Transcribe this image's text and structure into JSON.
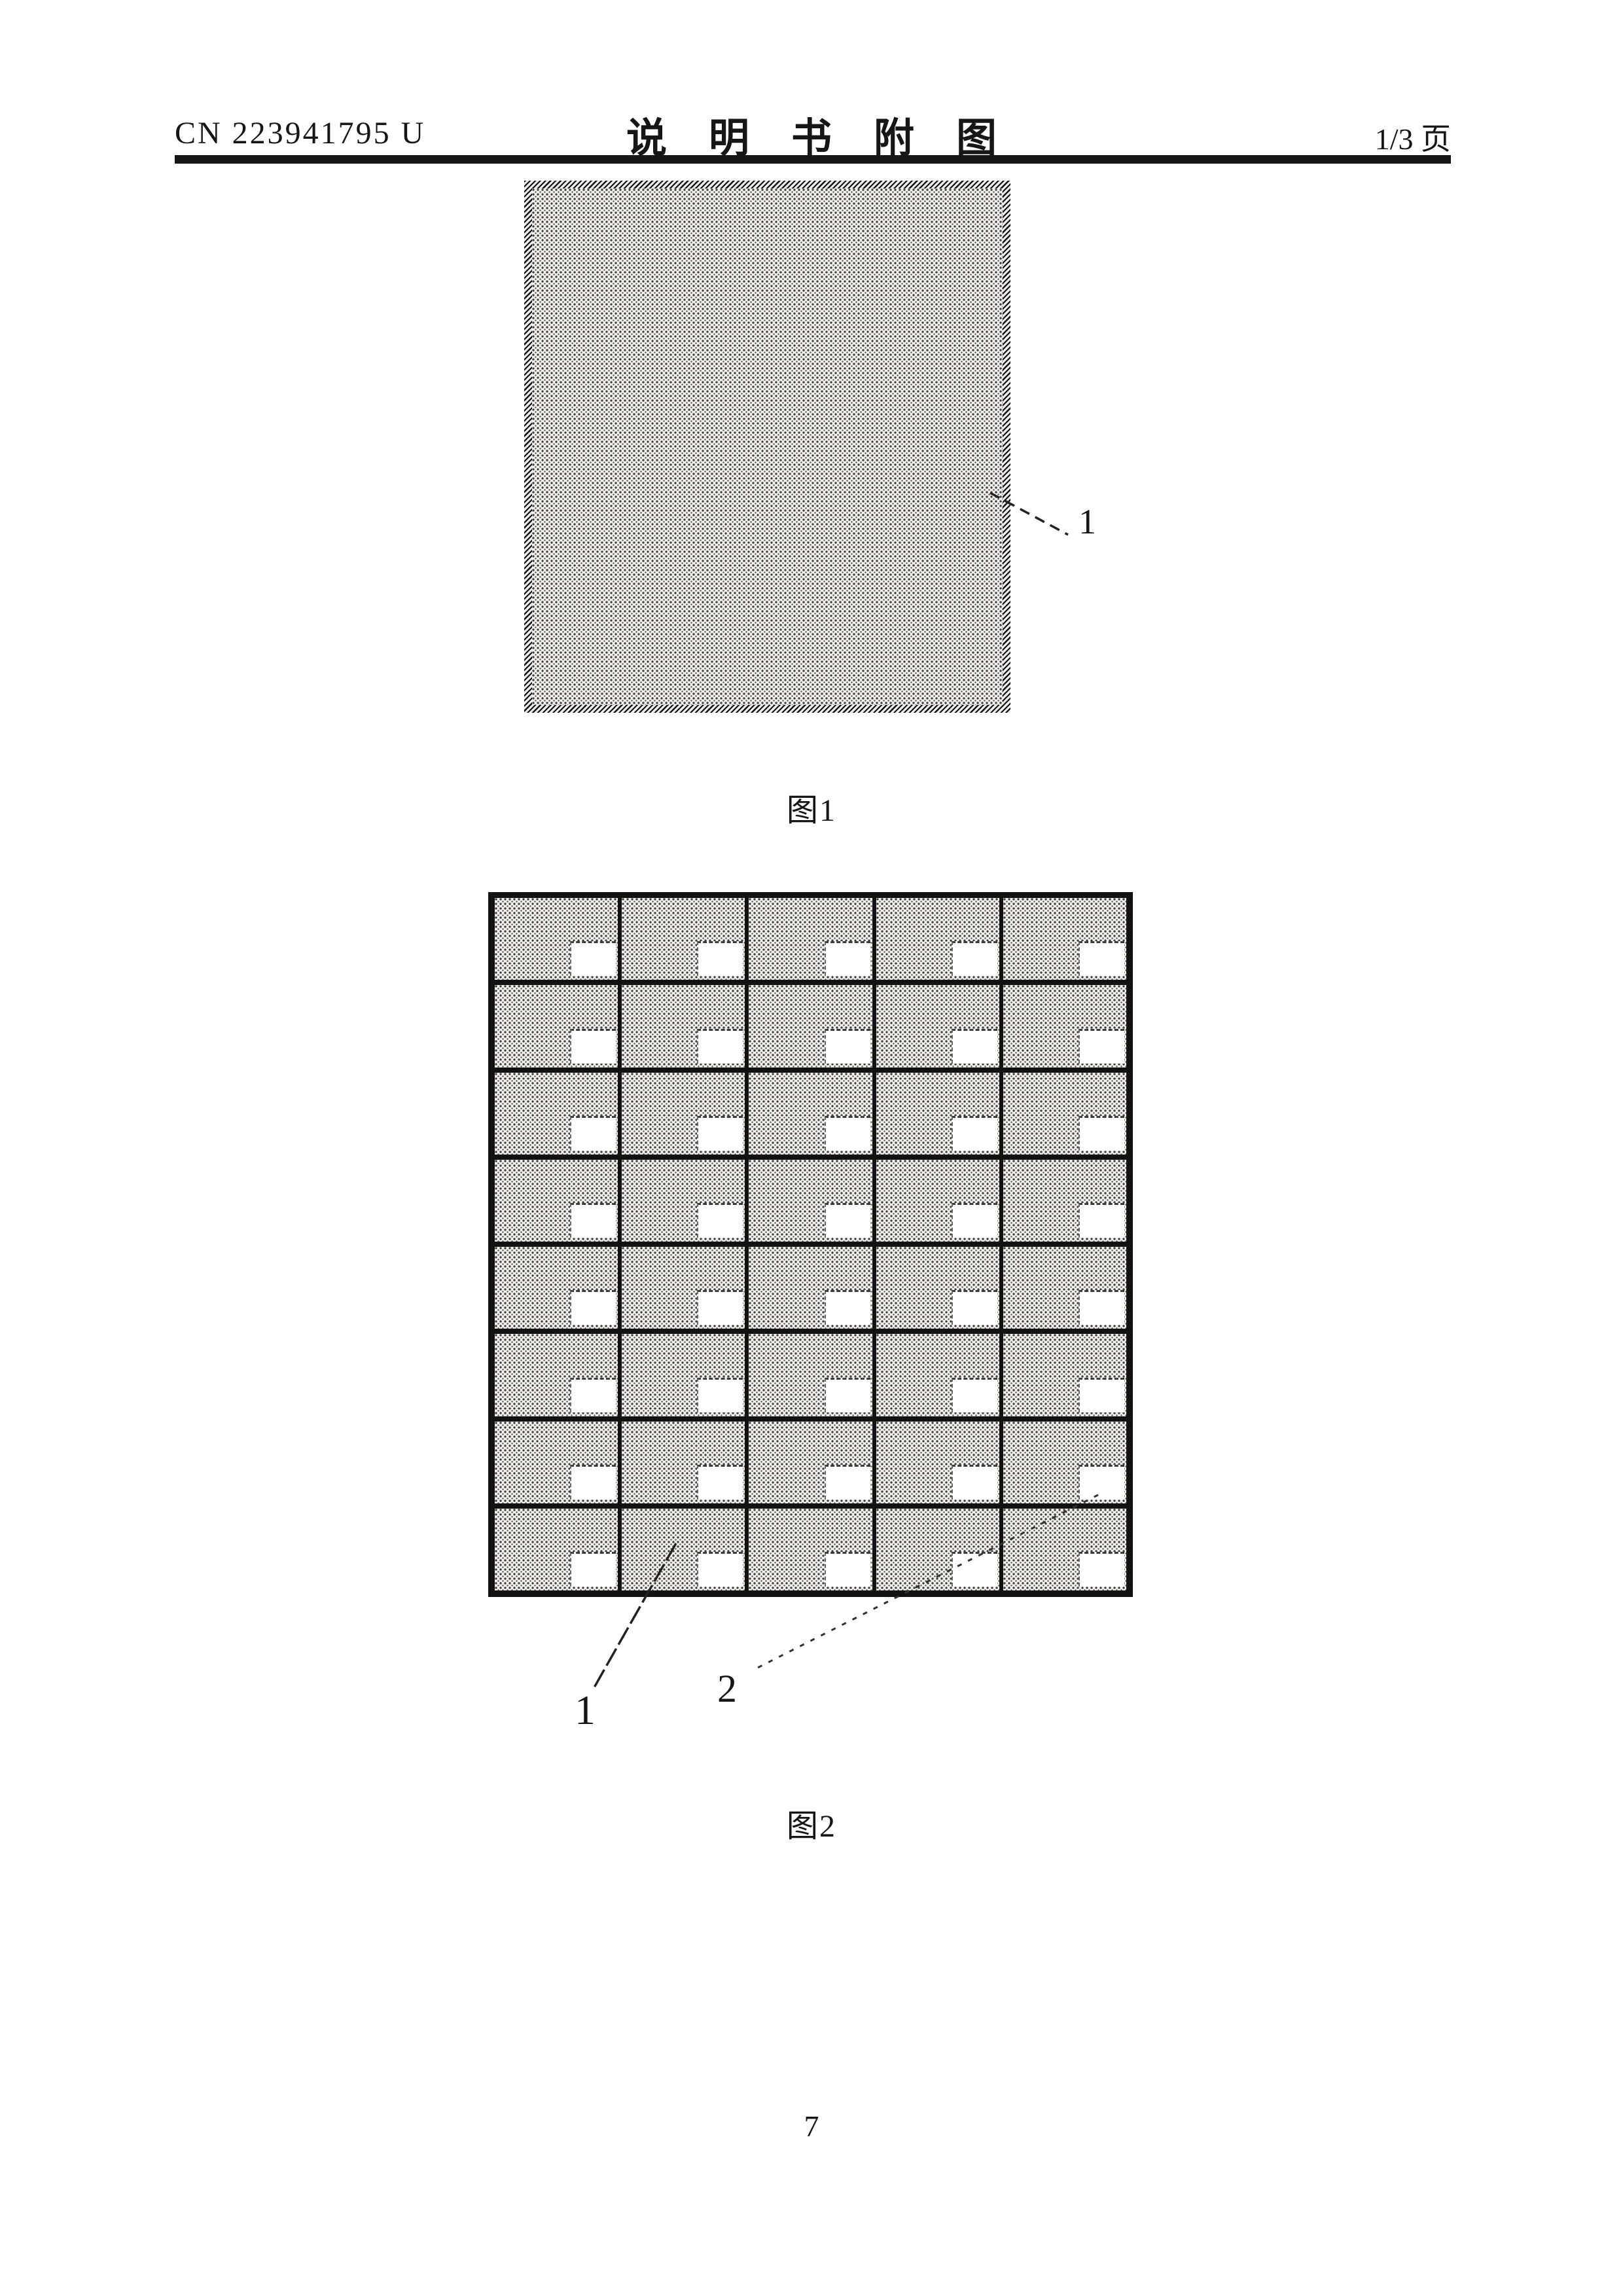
{
  "header": {
    "doc_number": "CN 223941795 U",
    "title": "说明书附图",
    "page_indicator": "1/3 页"
  },
  "figure1": {
    "caption": "图1",
    "label_panel": "1"
  },
  "figure2": {
    "caption": "图2",
    "label_panel": "1",
    "label_hole": "2",
    "grid": {
      "rows": 8,
      "cols": 5,
      "holes_per_cell": 1
    }
  },
  "page_number": "7",
  "colors": {
    "paper": "#ffffff",
    "ink": "#161616",
    "stipple_dot": "#3f3f3f",
    "stipple_background": "#f2f1ee"
  }
}
